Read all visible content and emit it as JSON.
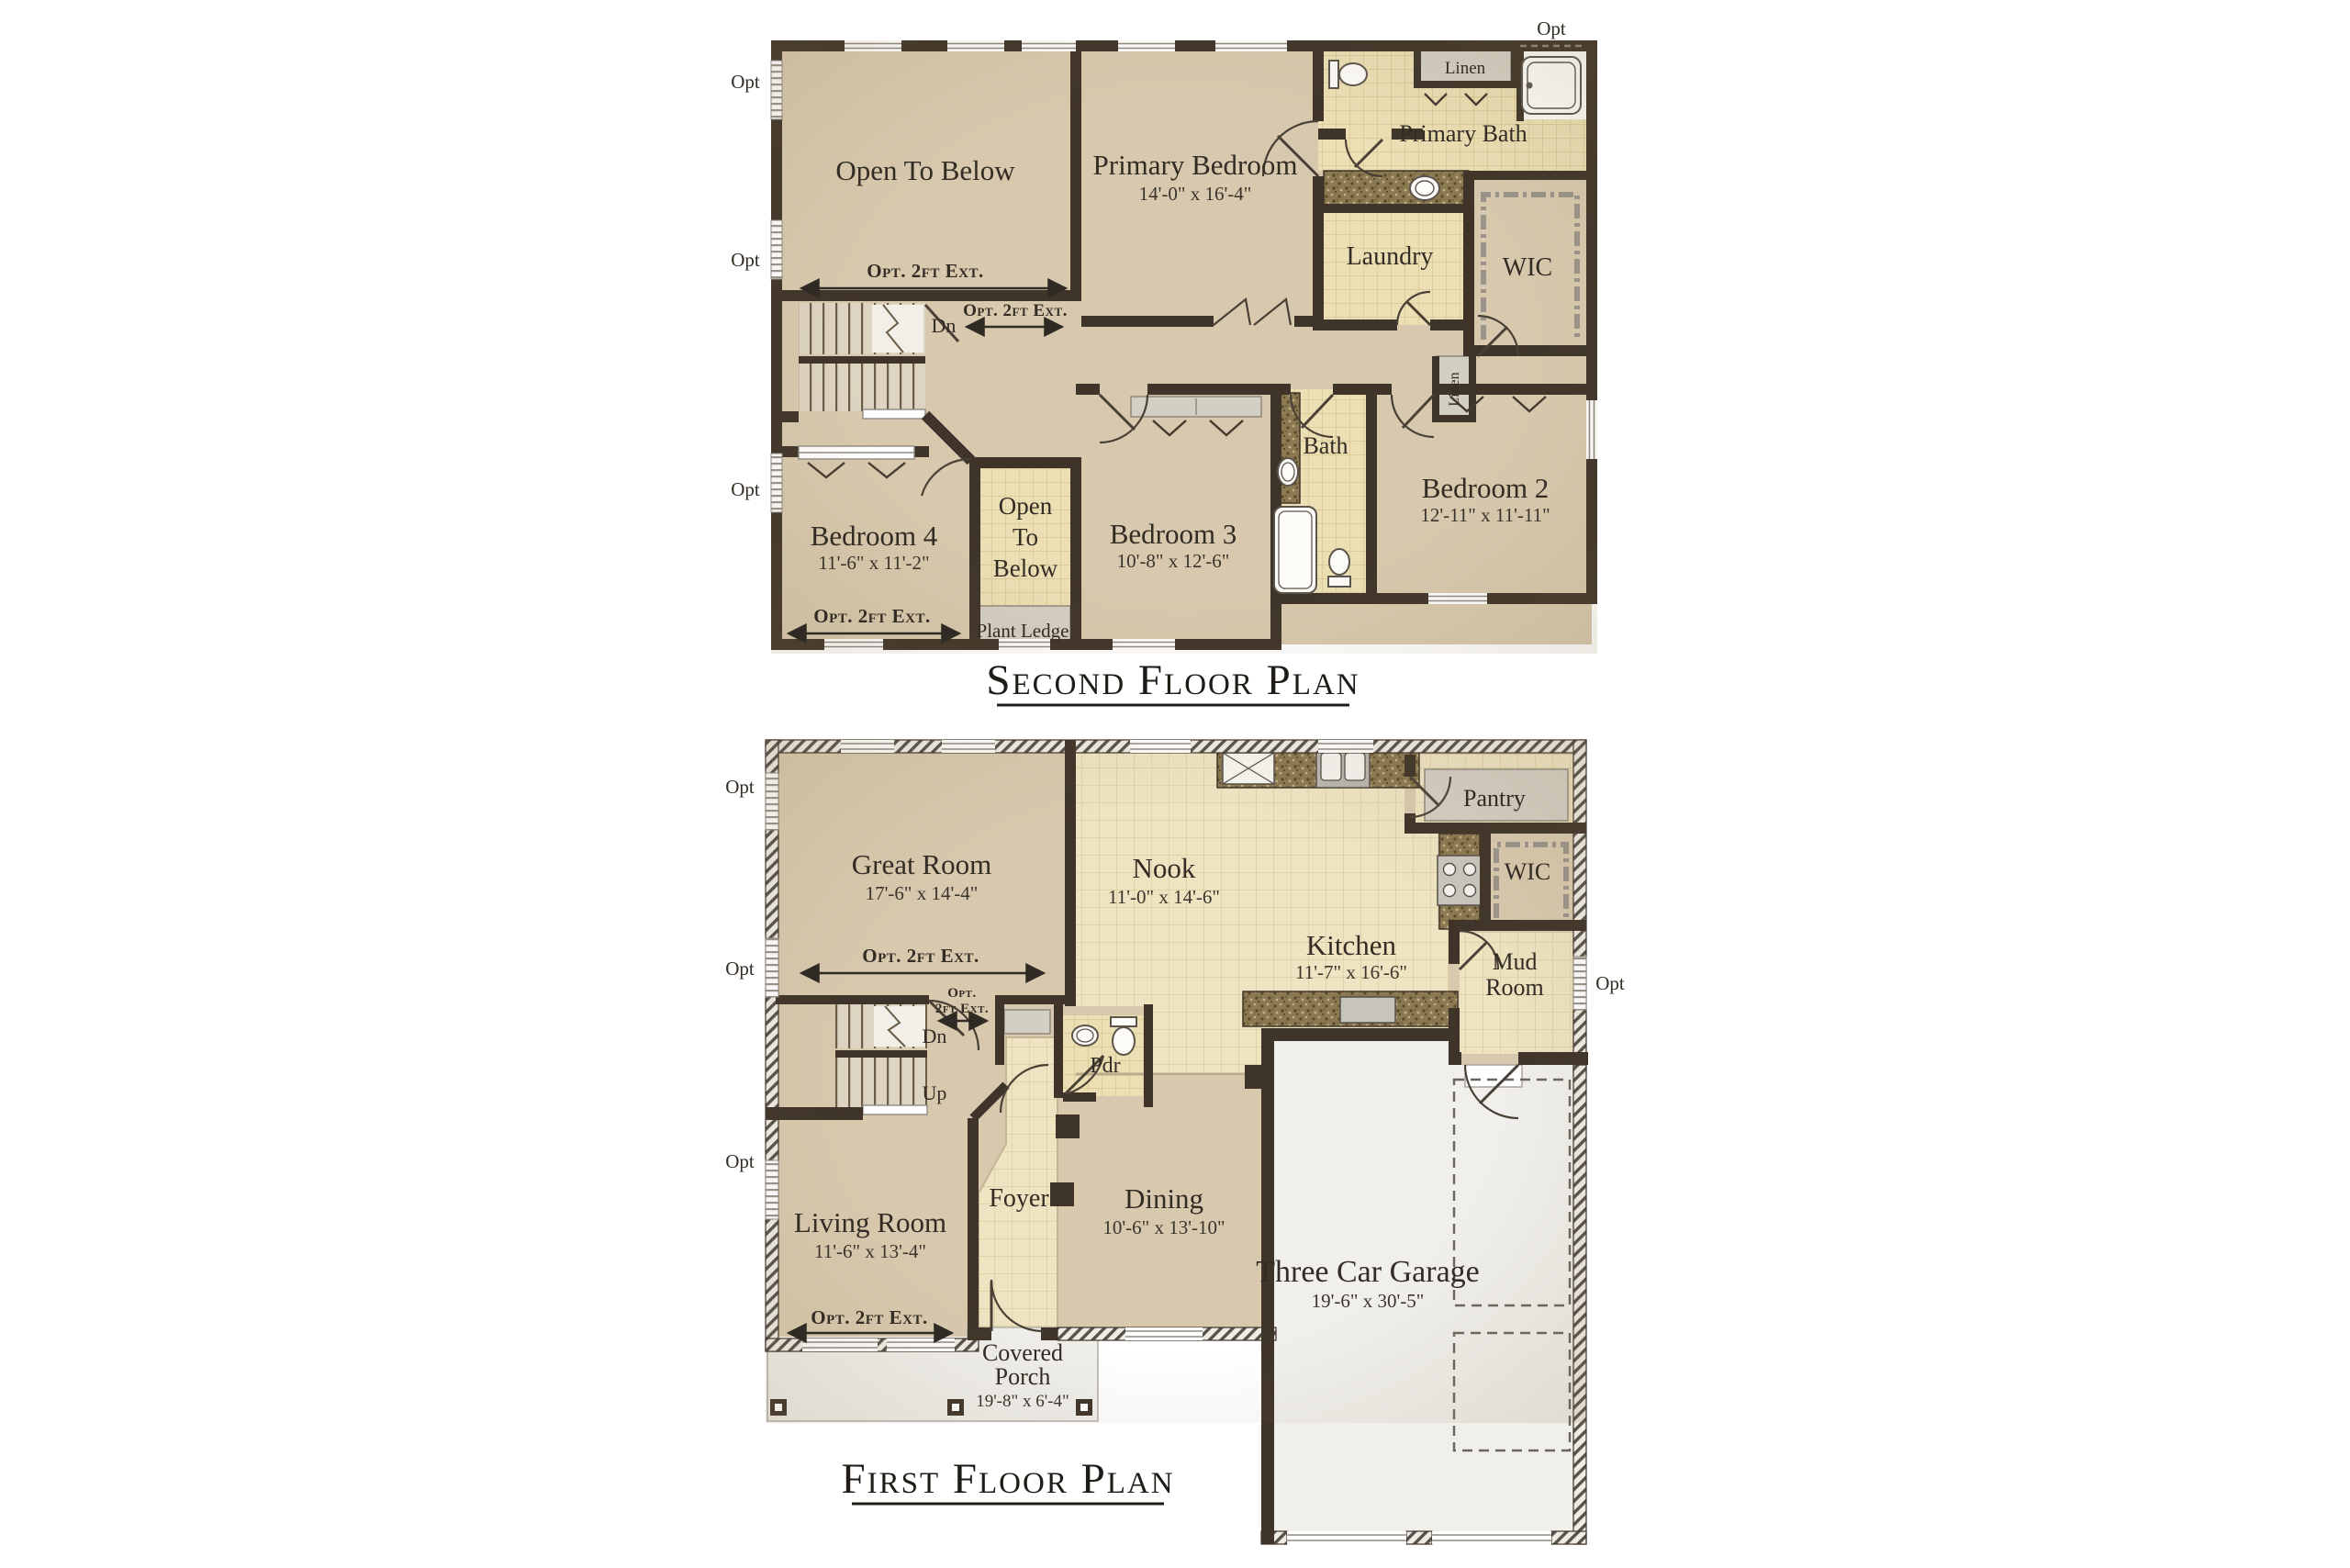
{
  "document": {
    "type": "architectural-floor-plan-sheet",
    "background": "#ffffff"
  },
  "colors": {
    "wall": "#3f3429",
    "floor_tan": "#d8c9ae",
    "tile_small": "#ecdfb4",
    "tile_large": "#eee4c2",
    "counter": "#8a7951",
    "closet_gray": "#d4cfc3",
    "garage_floor": "#f0efeb",
    "text": "#322c24"
  },
  "titles": {
    "second": "Second Floor Plan",
    "first": "First Floor Plan"
  },
  "labels": {
    "opt": "Opt",
    "opt_2ft_ext": "Opt. 2ft Ext.",
    "opt_2ft_ext_line1": "Opt.",
    "opt_2ft_ext_line2": "2ft Ext.",
    "dn": "Dn",
    "up": "Up",
    "linen": "Linen",
    "plant_ledge": "Plant Ledge"
  },
  "second_floor": {
    "rooms": {
      "open_to_below": {
        "label": "Open To Below"
      },
      "primary_bedroom": {
        "label": "Primary Bedroom",
        "dims": "14'-0\" x 16'-4\""
      },
      "primary_bath": {
        "label": "Primary Bath"
      },
      "laundry": {
        "label": "Laundry"
      },
      "wic": {
        "label": "WIC"
      },
      "bath": {
        "label": "Bath"
      },
      "bedroom2": {
        "label": "Bedroom 2",
        "dims": "12'-11\" x 11'-11\""
      },
      "bedroom3": {
        "label": "Bedroom 3",
        "dims": "10'-8\" x 12'-6\""
      },
      "bedroom4": {
        "label": "Bedroom 4",
        "dims": "11'-6\" x 11'-2\""
      },
      "open_to_below_small": {
        "lines": [
          "Open",
          "To",
          "Below"
        ]
      }
    }
  },
  "first_floor": {
    "rooms": {
      "great_room": {
        "label": "Great Room",
        "dims": "17'-6\" x 14'-4\""
      },
      "nook": {
        "label": "Nook",
        "dims": "11'-0\" x 14'-6\""
      },
      "kitchen": {
        "label": "Kitchen",
        "dims": "11'-7\" x 16'-6\""
      },
      "pantry": {
        "label": "Pantry"
      },
      "wic": {
        "label": "WIC"
      },
      "mud_room": {
        "lines": [
          "Mud",
          "Room"
        ]
      },
      "pdr": {
        "label": "Pdr"
      },
      "living_room": {
        "label": "Living Room",
        "dims": "11'-6\" x 13'-4\""
      },
      "foyer": {
        "label": "Foyer"
      },
      "dining": {
        "label": "Dining",
        "dims": "10'-6\" x 13'-10\""
      },
      "garage": {
        "label": "Three Car Garage",
        "dims": "19'-6\" x 30'-5\""
      },
      "covered_porch": {
        "lines": [
          "Covered",
          "Porch"
        ],
        "dims": "19'-8\" x 6'-4\""
      }
    }
  }
}
